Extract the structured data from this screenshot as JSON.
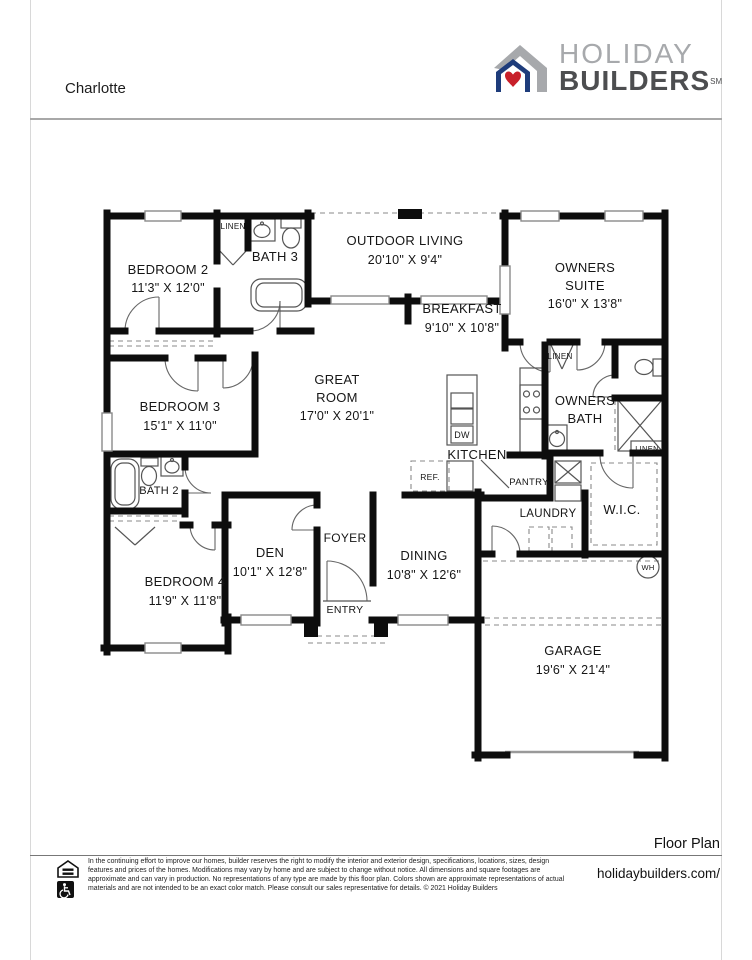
{
  "header": {
    "plan_name": "Charlotte",
    "logo": {
      "word1": "HOLIDAY",
      "word2": "BUILDERS",
      "trademark": "SM"
    }
  },
  "colors": {
    "wall": "#0d0d0d",
    "logo_gray": "#a7a9ac",
    "logo_blue": "#1e3c7b",
    "logo_red": "#c8202a",
    "logo_dark": "#4d4e50"
  },
  "rooms": {
    "bedroom2": {
      "name": "BEDROOM 2",
      "dims": "11'3\" X 12'0\""
    },
    "bath3": {
      "name": "BATH 3"
    },
    "outdoor": {
      "name": "OUTDOOR LIVING",
      "dims": "20'10\" X 9'4\""
    },
    "owners_suite": {
      "name1": "OWNERS",
      "name2": "SUITE",
      "dims": "16'0\" X 13'8\""
    },
    "breakfast": {
      "name": "BREAKFAST",
      "dims": "9'10\" X 10'8\""
    },
    "bedroom3": {
      "name": "BEDROOM 3",
      "dims": "15'1\" X 11'0\""
    },
    "great_room": {
      "name1": "GREAT",
      "name2": "ROOM",
      "dims": "17'0\" X 20'1\""
    },
    "kitchen": {
      "name": "KITCHEN"
    },
    "owners_bath": {
      "name1": "OWNERS",
      "name2": "BATH"
    },
    "bath2": {
      "name": "BATH 2"
    },
    "den": {
      "name": "DEN",
      "dims": "10'1\" X 12'8\""
    },
    "foyer": {
      "name": "FOYER"
    },
    "dining": {
      "name": "DINING",
      "dims": "10'8\" X 12'6\""
    },
    "entry": {
      "name": "ENTRY"
    },
    "bedroom4": {
      "name": "BEDROOM 4",
      "dims": "11'9\" X 11'8\""
    },
    "garage": {
      "name": "GARAGE",
      "dims": "19'6\" X 21'4\""
    },
    "wic": {
      "name": "W.I.C."
    },
    "laundry": {
      "name": "LAUNDRY"
    },
    "pantry": {
      "name": "PANTRY"
    }
  },
  "fixtures": {
    "linen_hall": "LINEN",
    "linen_owners": "LINEN",
    "linen_bath": "LINEN",
    "ref": "REF.",
    "dw": "DW",
    "wh": "WH"
  },
  "footer": {
    "caption": "Floor Plan",
    "website": "holidaybuilders.com/",
    "disclaimer": "In the continuing effort to improve our homes, builder reserves the right to modify the interior and exterior design, specifications, locations, sizes, design features and prices of the homes. Modifications may vary by home and are subject to change without notice. All dimensions and square footages are approximate and can vary in production. No representations of any type are made by this floor plan. Colors shown are approximate representations of actual materials and are not intended to be an exact color match. Please consult our sales representative for details. © 2021 Holiday Builders"
  }
}
